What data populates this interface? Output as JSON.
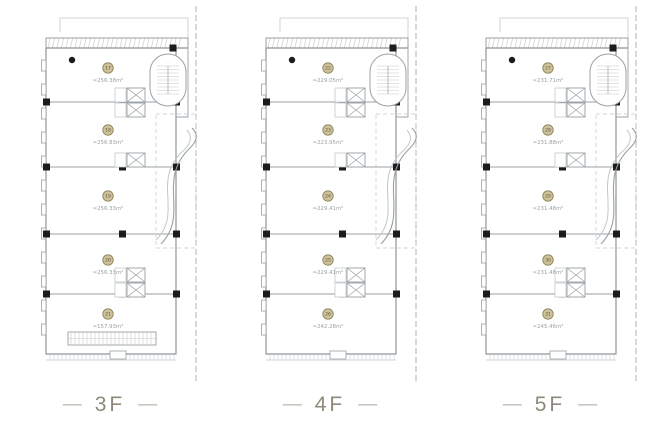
{
  "ui": {
    "dash": "—"
  },
  "colors": {
    "line": "#9aa0a4",
    "line_soft": "#c3c8cb",
    "wall": "#8e959a",
    "column": "#1c1c1c",
    "badge_fill": "#cdc29b",
    "badge_ring": "#8d8055",
    "badge_text": "#5f563a",
    "area_text": "#9aa0a4",
    "floor_label": "#8f897b"
  },
  "floors": [
    {
      "id": "3F",
      "label": "3F",
      "variant": "escalator-strip",
      "rooms": [
        {
          "number": "17",
          "area": "≈256.38m²"
        },
        {
          "number": "18",
          "area": "≈256.83m²"
        },
        {
          "number": "19",
          "area": "≈256.33m²"
        },
        {
          "number": "20",
          "area": "≈256.33m²"
        },
        {
          "number": "21",
          "area": "≈157.93m²"
        }
      ]
    },
    {
      "id": "4F",
      "label": "4F",
      "variant": "standard",
      "rooms": [
        {
          "number": "22",
          "area": "≈229.05m²"
        },
        {
          "number": "23",
          "area": "≈223.95m²"
        },
        {
          "number": "24",
          "area": "≈229.41m²"
        },
        {
          "number": "25",
          "area": "≈229.41m²"
        },
        {
          "number": "26",
          "area": "≈242.28m²"
        }
      ]
    },
    {
      "id": "5F",
      "label": "5F",
      "variant": "standard",
      "rooms": [
        {
          "number": "27",
          "area": "≈231.71m²"
        },
        {
          "number": "28",
          "area": "≈231.88m²"
        },
        {
          "number": "29",
          "area": "≈231.48m²"
        },
        {
          "number": "30",
          "area": "≈231.48m²"
        },
        {
          "number": "31",
          "area": "≈245.46m²"
        }
      ]
    }
  ]
}
